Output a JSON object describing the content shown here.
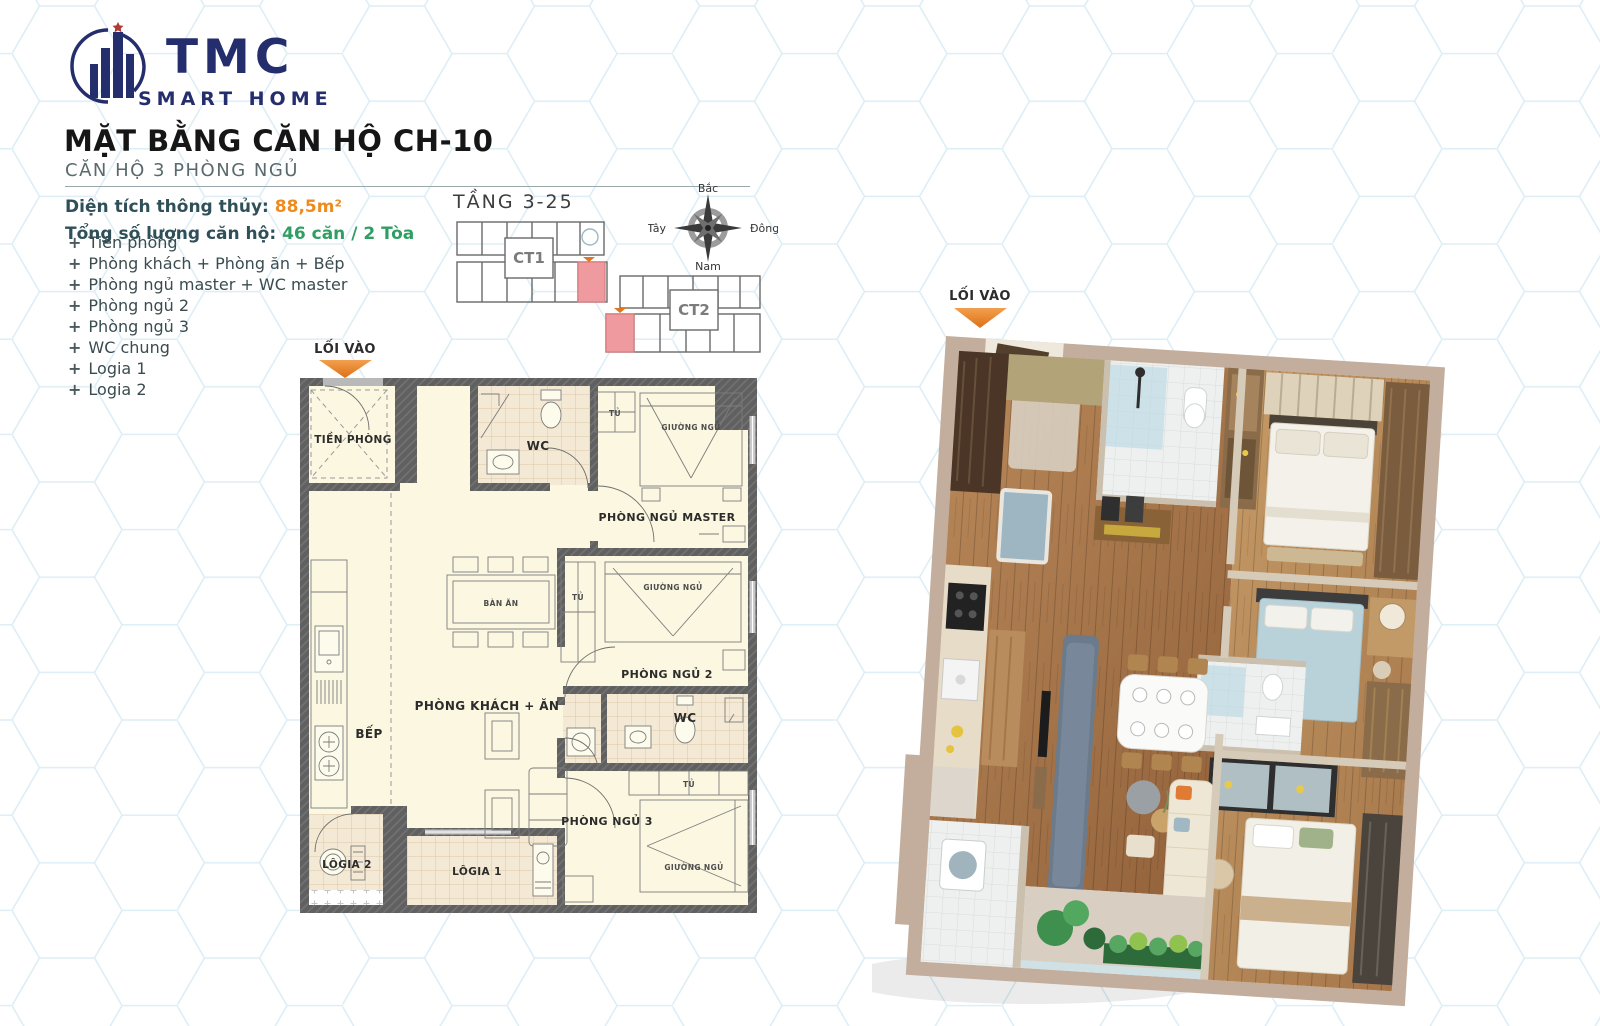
{
  "logo": {
    "title": "TMC",
    "subtitle": "SMART HOME"
  },
  "header": {
    "title": "MẶT BẰNG CĂN HỘ CH-10",
    "subtitle": "CĂN HỘ 3 PHÒNG NGỦ"
  },
  "specs": {
    "area_label": "Diện tích thông thủy: ",
    "area_value": "88,5m²",
    "units_label": "Tổng số lượng căn hộ:",
    "units_value": "46 căn / 2 Tòa"
  },
  "room_list": {
    "bullet": "+",
    "items": [
      "Tiền phòng",
      "Phòng khách + Phòng ăn + Bếp",
      "Phòng ngủ master + WC master",
      "Phòng ngủ 2",
      "Phòng ngủ 3",
      "WC chung",
      "Logia 1",
      "Logia 2"
    ]
  },
  "keyplan": {
    "title": "TẦNG 3-25",
    "ct1": "CT1",
    "ct2": "CT2"
  },
  "compass": {
    "north": "Bắc",
    "south": "Nam",
    "east": "Đông",
    "west": "Tây"
  },
  "plan2d": {
    "entry": "LỐI VÀO",
    "tien_phong": "TIỀN PHÒNG",
    "wc": "WC",
    "phong_ngu_master": "PHÒNG NGỦ MASTER",
    "phong_ngu_2": "PHÒNG NGỦ 2",
    "phong_ngu_3": "PHÒNG NGỦ 3",
    "phong_khach_an": "PHÒNG KHÁCH + ĂN",
    "bep": "BẾP",
    "ban_an": "BÀN ĂN",
    "giuong_ngu": "GIƯỜNG NGỦ",
    "tu": "TỦ",
    "logia1": "LÔGIA 1",
    "logia2": "LÔGIA 2"
  },
  "plan3d": {
    "entry": "LỐI VÀO"
  },
  "colors": {
    "accent_orange": "#ef8b1d",
    "accent_green": "#2f9e63",
    "brand_navy": "#242e6c",
    "highlight_pink": "#ee9a9e",
    "wall_gray": "#5f5f5f",
    "floor_cream": "#fbf7e1",
    "hex_line": "#d2e8f3"
  }
}
